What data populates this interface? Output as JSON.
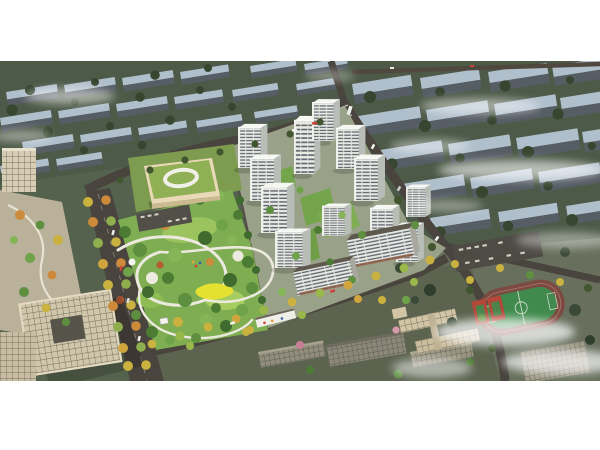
{
  "page": {
    "background": "#ffffff"
  },
  "image": {
    "type": "architectural-aerial-rendering",
    "title": "Residential development master plan — aerial view",
    "alt": "Aerial architectural rendering of a residential development: a cluster of white high-rise apartment towers beside a large landscaped central park with winding white paths, a kindergarten with a green roof at the upper left of the site, tree-lined boulevards with autumn trees, beige office buildings in the left foreground, a school campus with a green sports field and running track at the lower right, and rows of muted existing city blocks fading into white mist in the background."
  },
  "scene": {
    "regions": [
      {
        "name": "background-city-blocks",
        "label": "Existing city blocks in mist"
      },
      {
        "name": "road-network",
        "label": "Site roads and boulevard"
      },
      {
        "name": "central-park",
        "label": "Central landscaped park"
      },
      {
        "name": "kindergarten",
        "label": "Kindergarten with green roof"
      },
      {
        "name": "residential-towers",
        "label": "White residential high-rise cluster"
      },
      {
        "name": "office-complex",
        "label": "Beige office complex and plaza"
      },
      {
        "name": "school-campus",
        "label": "School campus with sports field and track"
      },
      {
        "name": "mist",
        "label": "Low clouds and mist"
      }
    ],
    "palette": {
      "terrain": "#52604c",
      "background_building_top": "#b0bfcc",
      "background_building_side": "#565d64",
      "tower_facade": "#e9eae4",
      "tower_window_band": "#5c636c",
      "park_green": "#7fae52",
      "tree_dark": "#3a4a36",
      "autumn_tree": "#cc8a3a",
      "yellow_tree": "#c9b23f",
      "road": "#4a443e",
      "office_beige": "#cfc6ab",
      "sports_field": "#3f8a4c",
      "running_track": "#7c4a41",
      "court_red": "#b5473a",
      "kindergarten_roof": "#8fb055",
      "lawn_highlight": "#e6e030",
      "cloud": "#ffffff"
    }
  }
}
